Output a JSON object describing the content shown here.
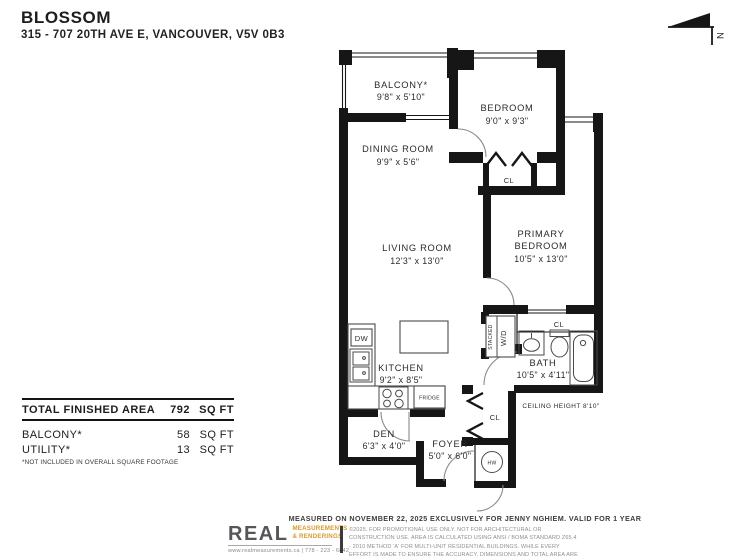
{
  "header": {
    "title": "BLOSSOM",
    "address": "315 - 707 20TH AVE E, VANCOUVER, V5V 0B3"
  },
  "north_label": "N",
  "plan": {
    "balcony": {
      "name": "BALCONY*",
      "dims": "9'8\" x 5'10\""
    },
    "bedroom": {
      "name": "BEDROOM",
      "dims": "9'0\" x 9'3\""
    },
    "dining_room": {
      "name": "DINING ROOM",
      "dims": "9'9\" x 5'6\""
    },
    "living_room": {
      "name": "LIVING ROOM",
      "dims": "12'3\" x 13'0\""
    },
    "primary_bedroom": {
      "name_line1": "PRIMARY",
      "name_line2": "BEDROOM",
      "dims": "10'5\" x 13'0\""
    },
    "kitchen": {
      "name": "KITCHEN",
      "dims": "9'2\" x 8'5\""
    },
    "bath": {
      "name": "BATH",
      "dims": "10'5\" x 4'11\""
    },
    "den": {
      "name": "DEN",
      "dims": "6'3\" x 4'0\""
    },
    "foyer": {
      "name": "FOYER",
      "dims": "5'0\" x 6'0\""
    },
    "labels": {
      "closet": "CL",
      "dishwasher": "DW",
      "fridge": "FRIDGE",
      "washer_dryer": "W/D",
      "stacked": "STACKED",
      "hot_water": "HW"
    },
    "ceiling_note": "CEILING HEIGHT 8'10\""
  },
  "areas": {
    "total": {
      "label": "TOTAL FINISHED AREA",
      "value": "792",
      "unit": "SQ FT"
    },
    "rows": [
      {
        "label": "BALCONY*",
        "value": "58",
        "unit": "SQ FT"
      },
      {
        "label": "UTILITY*",
        "value": "13",
        "unit": "SQ FT"
      }
    ],
    "footnote": "*NOT INCLUDED IN OVERALL SQUARE FOOTAGE"
  },
  "footer": {
    "measured_line": "MEASURED ON NOVEMBER 22, 2025 EXCLUSIVELY FOR JENNY NGHIEM. VALID FOR 1 YEAR",
    "logo": {
      "name": "REAL",
      "sub_line1": "MEASUREMENTS",
      "sub_line2": "& RENDERINGS",
      "contact": "www.realmeasurements.ca | 778 - 223 - 6842"
    },
    "disclaimer": "©2025. FOR PROMOTIONAL USE ONLY. NOT FOR ARCHITECTURAL OR CONSTRUCTION USE. AREA IS CALCULATED USING ANSI / BOMA STANDARD Z65.4 - 2010 METHOD 'A' FOR MULTI-UNIT RESIDENTIAL BUILDINGS. WHILE EVERY EFFORT IS MADE TO ENSURE THE ACCURACY, DIMENSIONS AND TOTAL AREA ARE NOT GUARANTEED. E&OE"
  },
  "colors": {
    "wall": "#161616",
    "logo_gray": "#55565a",
    "logo_gold": "#d59b2d"
  }
}
